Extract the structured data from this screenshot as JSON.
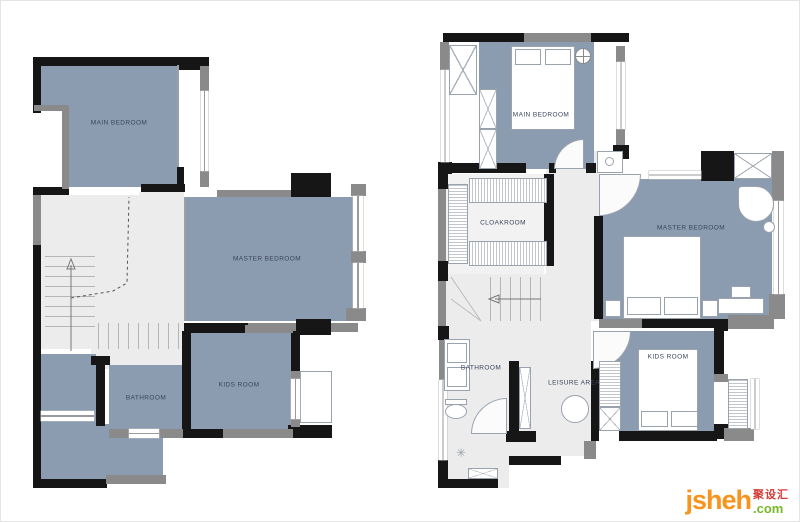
{
  "left_plan": {
    "name": "lower floor plan",
    "rooms": [
      {
        "label": "MAIN BEDROOM"
      },
      {
        "label": "MASTER BEDROOM"
      },
      {
        "label": "KIDS ROOM"
      },
      {
        "label": "BATHROOM"
      }
    ]
  },
  "right_plan": {
    "name": "upper floor plan",
    "rooms": [
      {
        "label": "MAIN BEDROOM"
      },
      {
        "label": "CLOAKROOM"
      },
      {
        "label": "MASTER BEDROOM"
      },
      {
        "label": "KIDS ROOM"
      },
      {
        "label": "BATHROOM"
      },
      {
        "label": "LEISURE AREA"
      }
    ]
  },
  "watermark": {
    "brand": "jsheh",
    "tld": ".com",
    "cn": "聚设汇"
  },
  "colors": {
    "room_fill": "#8C9CB0",
    "floor": "#ECECEC",
    "wall_black": "#161616",
    "wall_gray": "#8A8A8A",
    "brand_orange": "#F7941D",
    "brand_green": "#76B82A",
    "brand_red": "#D63C36"
  }
}
